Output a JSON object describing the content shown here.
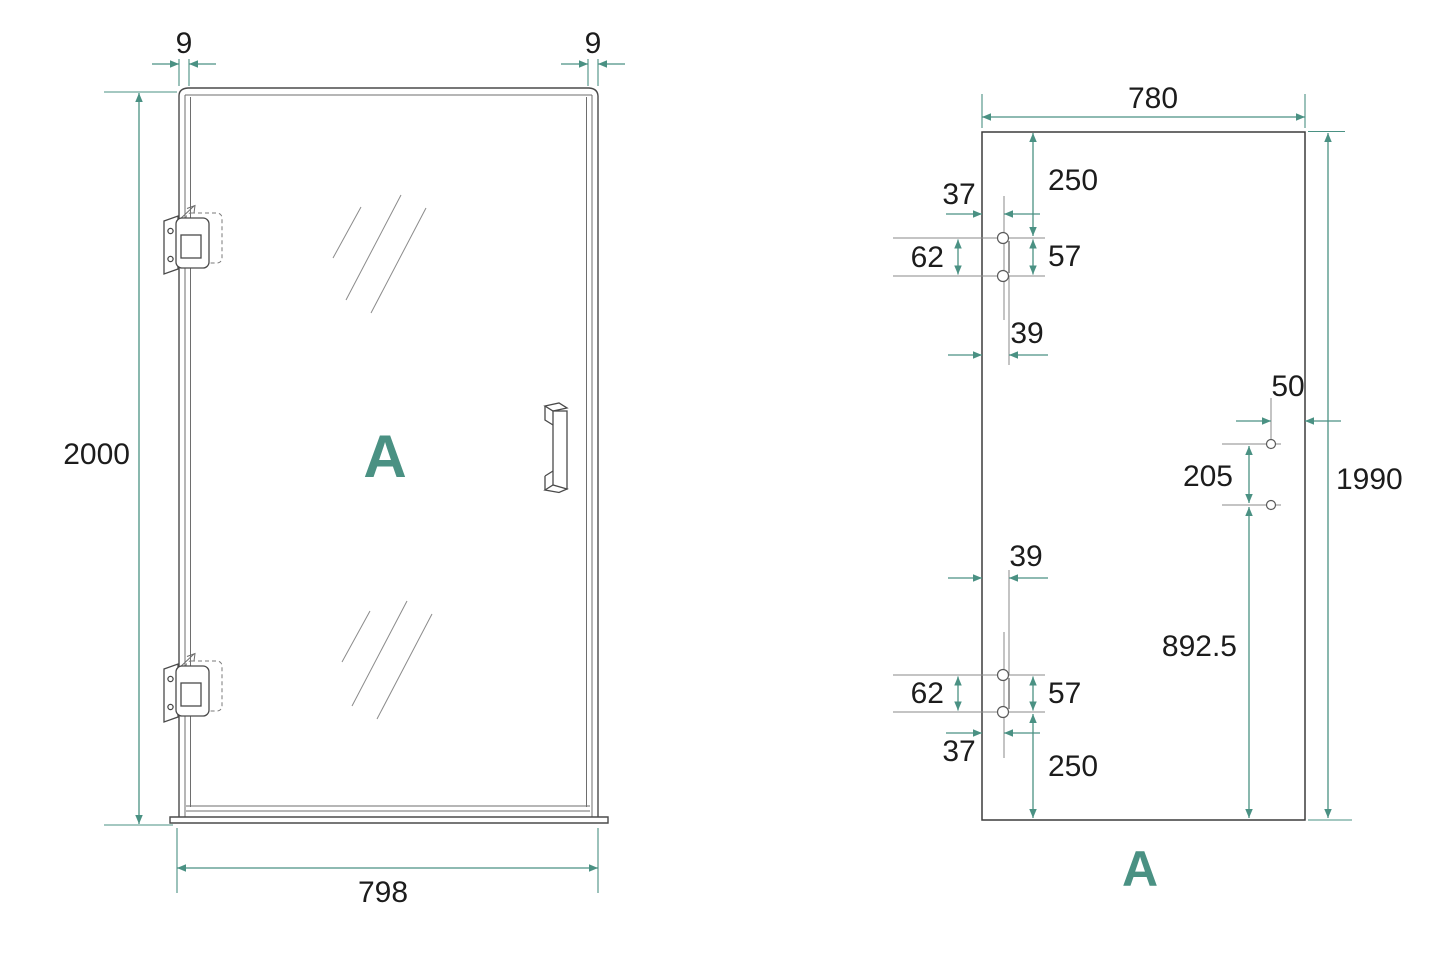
{
  "colors": {
    "accent": "#4a9183",
    "line": "#4a4a4a",
    "text": "#1c1c1c"
  },
  "door_view": {
    "label": "A",
    "dims": {
      "top_left_profile": "9",
      "top_right_profile": "9",
      "total_height": "2000",
      "total_width": "798"
    }
  },
  "glass_view": {
    "label": "A",
    "dims": {
      "glass_width": "780",
      "glass_height": "1990",
      "top_cutout_from_top": "250",
      "top_cutout_edge_offset": "37",
      "top_cutout_height_outer": "62",
      "top_cutout_height_inner": "57",
      "top_cutout_depth": "39",
      "handle_hole_to_edge": "50",
      "handle_hole_spacing": "205",
      "handle_hole_to_bottom": "892.5",
      "bottom_cutout_depth": "39",
      "bottom_cutout_height_outer": "62",
      "bottom_cutout_height_inner": "57",
      "bottom_cutout_edge_offset": "37",
      "bottom_cutout_from_bottom": "250"
    }
  }
}
